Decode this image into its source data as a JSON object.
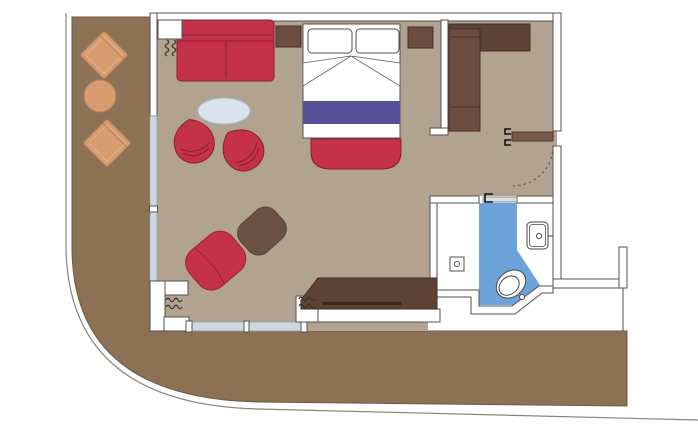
{
  "plan": {
    "kind": "floor-plan",
    "areas": [
      {
        "name": "wrap-around-deck",
        "description": "balcony deck wrapping left side and bottom"
      },
      {
        "name": "living-bedroom",
        "description": "combined lounge and sleeping area"
      },
      {
        "name": "entry",
        "description": "entrance vestibule with swing door"
      },
      {
        "name": "closet",
        "description": "wardrobe nook"
      },
      {
        "name": "bathroom",
        "description": "bathroom with wet area"
      }
    ],
    "furniture": {
      "balcony": [
        "lounge-chair",
        "round-table",
        "lounge-chair"
      ],
      "living": [
        "sofa",
        "coffee-table",
        "tub-chair",
        "tub-chair",
        "chaise-chair",
        "ottoman",
        "desk-console"
      ],
      "bedroom": [
        "double-bed",
        "pillow",
        "pillow",
        "bed-runner",
        "foot-bench",
        "nightstand",
        "nightstand",
        "wardrobe"
      ],
      "bathroom": [
        "toilet",
        "sink",
        "shower-wet-area",
        "floor-drain"
      ]
    }
  },
  "colors": {
    "background": "#ffffff",
    "deck": "#8c7154",
    "room_floor": "#b2a390",
    "wall_fill": "#ffffff",
    "wall_line": "#55504a",
    "red_furniture": "#c53147",
    "red_outline": "#871f2d",
    "purple_runner": "#585096",
    "coffee_table": "#d9e4ef",
    "wood": "#6d4c41",
    "wood_dark": "#5e4137",
    "ottoman_brown": "#6b5044",
    "outdoor_furniture": "#d79d71",
    "wet_area_blue": "#6ea3d9",
    "glass": "#cdd8e2",
    "entry_door": "#77584a",
    "bathroom_door": "#dbe0e5",
    "white_fixture": "#ffffff"
  }
}
